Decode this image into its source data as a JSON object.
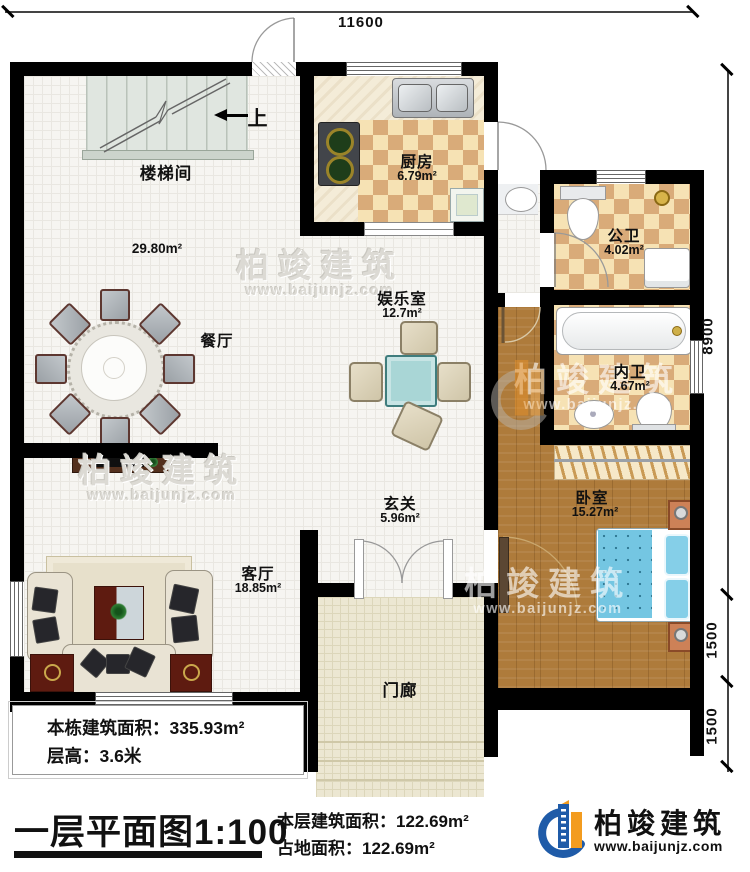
{
  "dimensions": {
    "top_width": "11600",
    "right_height": "8900",
    "right_seg_a": "1500",
    "right_seg_b": "1500"
  },
  "rooms": [
    {
      "name": "楼梯间",
      "area": ""
    },
    {
      "name": "厨房",
      "area": "6.79m²"
    },
    {
      "name": "公卫",
      "area": "4.02m²"
    },
    {
      "name": "内卫",
      "area": "4.67m²"
    },
    {
      "name": "娱乐室",
      "area": "12.7m²"
    },
    {
      "name": "餐厅",
      "area": "29.80m²"
    },
    {
      "name": "玄关",
      "area": "5.96m²"
    },
    {
      "name": "卧室",
      "area": "15.27m²"
    },
    {
      "name": "客厅",
      "area": "18.85m²"
    },
    {
      "name": "门廊",
      "area": ""
    }
  ],
  "stairs": {
    "up_label": "上"
  },
  "info_box": {
    "building_area": "本栋建筑面积：335.93m²",
    "floor_height": "层高：3.6米"
  },
  "title": "一层平面图1:100",
  "floor_info": {
    "floor_area": "本层建筑面积：122.69m²",
    "land_area": "占地面积：122.69m²"
  },
  "brand": {
    "name": "柏竣建筑",
    "website": "www.baijunjz.com"
  },
  "watermark": {
    "text": "柏竣建筑",
    "url": "www.baijunjz.com"
  },
  "colors": {
    "wall": "#000000",
    "logo_blue": "#1f5ba8",
    "logo_orange": "#f39c1f",
    "bed": "#74c6e2",
    "wood": "#ae7b3b",
    "checker": "#d9ab79"
  }
}
